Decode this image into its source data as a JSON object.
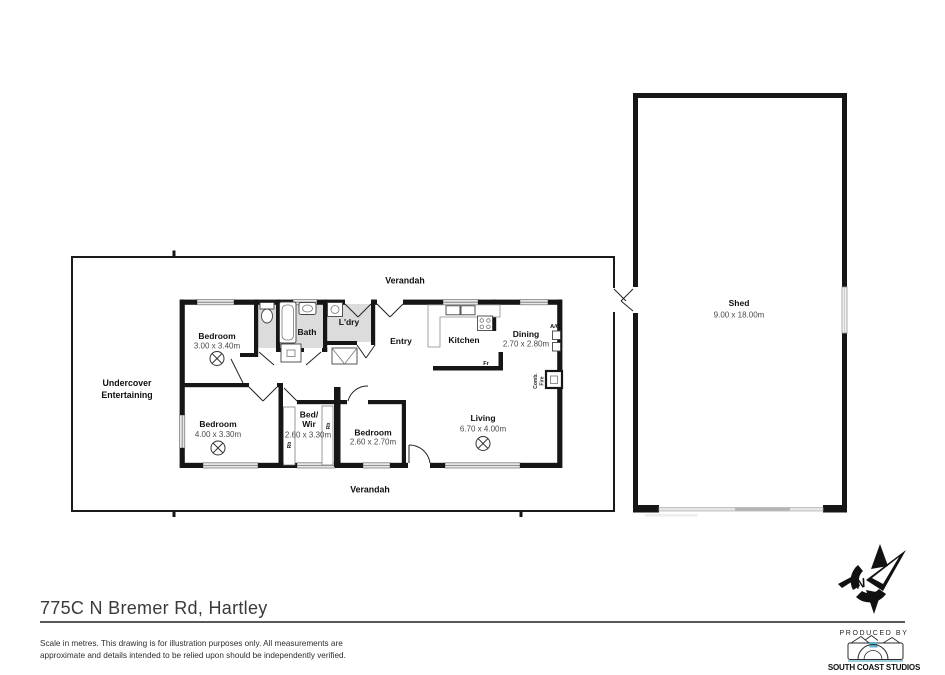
{
  "plan": {
    "verandah_top": "Verandah",
    "verandah_bottom": "Verandah",
    "undercover_line1": "Undercover",
    "undercover_line2": "Entertaining",
    "rooms": {
      "bedroom1": {
        "name": "Bedroom",
        "dims": "3.00 x 3.40m"
      },
      "bedroom2": {
        "name": "Bedroom",
        "dims": "4.00 x 3.30m"
      },
      "bedroom3": {
        "name": "Bedroom",
        "dims": "2.60 x 2.70m"
      },
      "bedwir": {
        "name_line1": "Bed/",
        "name_line2": "Wir",
        "dims": "2.60 x 3.30m"
      },
      "bath": {
        "name": "Bath"
      },
      "ldry": {
        "name": "L'dry"
      },
      "entry": {
        "name": "Entry"
      },
      "kitchen": {
        "name": "Kitchen"
      },
      "dining": {
        "name": "Dining",
        "dims": "2.70 x 2.80m"
      },
      "living": {
        "name": "Living",
        "dims": "6.70 x 4.00m"
      },
      "shed": {
        "name": "Shed",
        "dims": "9.00 x 18.00m"
      }
    },
    "annotations": {
      "fridge": "Fr",
      "ac": "A/C",
      "comb": "Comb.",
      "fire": "Fire",
      "robe_left": "Rb",
      "robe_right": "Rb"
    }
  },
  "footer": {
    "address": "775C N Bremer Rd, Hartley",
    "disclaimer_line1": "Scale in metres. This drawing is for illustration purposes only. All measurements are",
    "disclaimer_line2": "approximate and details intended to be relied upon should be independently verified.",
    "produced_by": "PRODUCED BY",
    "studio": "SOUTH COAST STUDIOS"
  },
  "colors": {
    "wall": "#161616",
    "window_fill": "#e6e6e6",
    "floor_gray": "#dcdcdc",
    "accent_blue": "#62b1d0"
  }
}
